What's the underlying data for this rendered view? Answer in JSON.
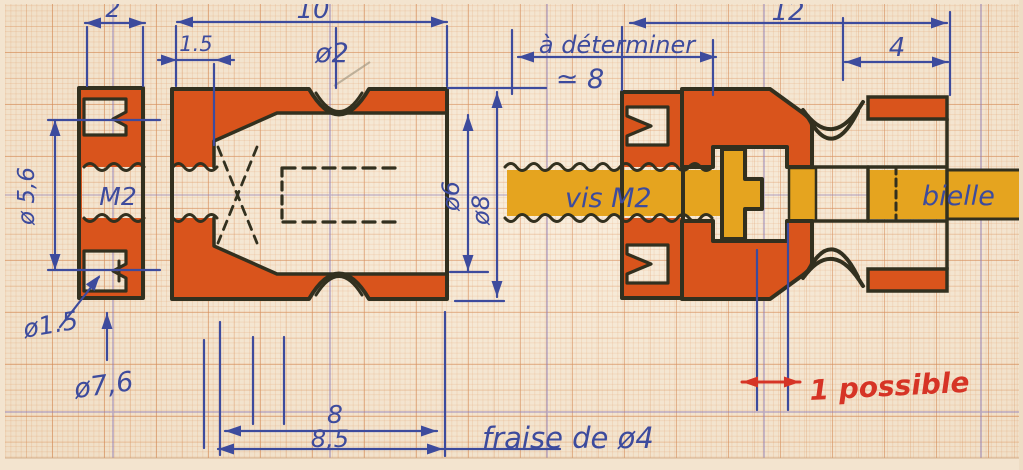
{
  "drawing": {
    "dimensions": {
      "d2": "2",
      "d10": "10",
      "d1_5": "1.5",
      "dia2": "ø2",
      "a_det": "à déterminer",
      "approx8": "≃ 8",
      "d12": "12",
      "d4": "4",
      "dia5_6": "ø 5,6",
      "m2": "M2",
      "dia1_5": "ø1.5",
      "dia7_6": "ø7,6",
      "dia6": "ø6",
      "dia8": "ø8",
      "d8": "8",
      "d8_5": "8,5",
      "fraise": "fraise de ø4"
    },
    "labels": {
      "vis": "vis M2",
      "bielle": "bielle",
      "possible": "1 possible"
    },
    "colors": {
      "ink_blue": "#3d4b9d",
      "outline_black": "#32301f",
      "part_orange": "#d9541c",
      "screw_yellow": "#e5a41f",
      "note_red": "#d63426",
      "paper": "#f6e9d6"
    }
  }
}
